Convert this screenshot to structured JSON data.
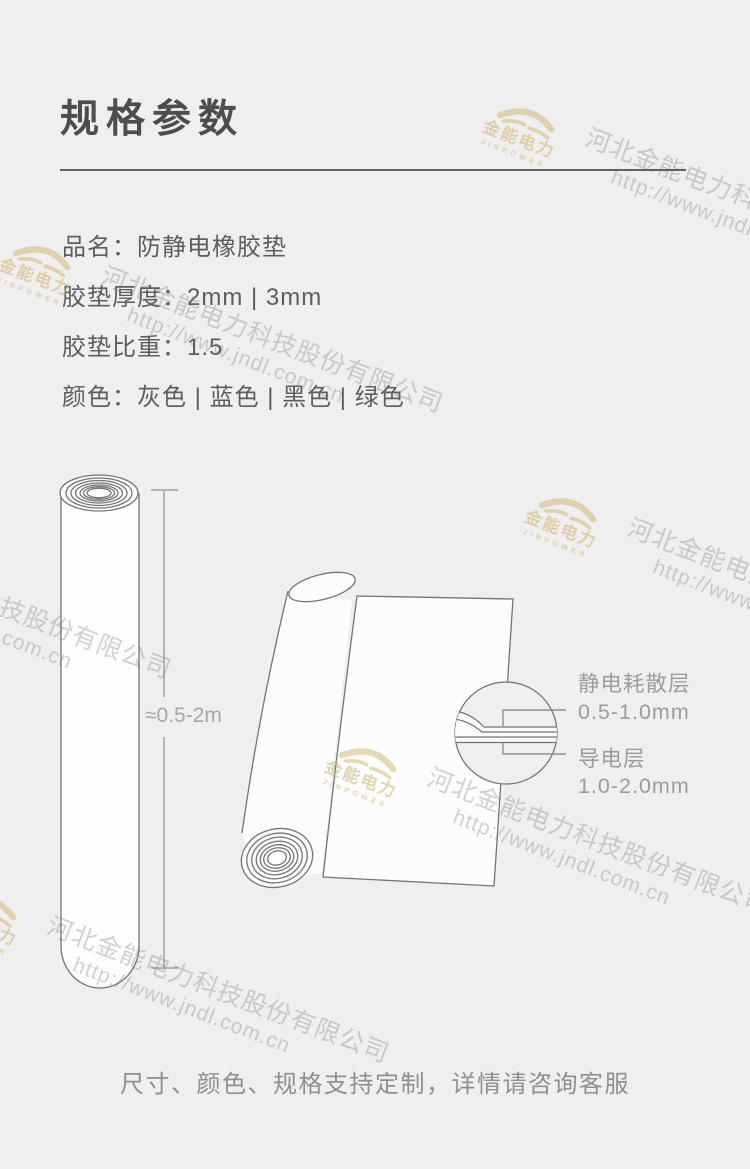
{
  "page": {
    "background": "#efefef",
    "title": "规格参数"
  },
  "specs": {
    "items": [
      {
        "text": "品名：防静电橡胶垫"
      },
      {
        "text": "胶垫厚度：2mm | 3mm"
      },
      {
        "text": "胶垫比重：1.5"
      },
      {
        "text": "颜色：灰色 | 蓝色 | 黑色 | 绿色"
      }
    ]
  },
  "diagram": {
    "roll_height_label": "≈0.5-2m",
    "layer1": {
      "name": "静电耗散层",
      "thickness": "0.5-1.0mm"
    },
    "layer2": {
      "name": "导电层",
      "thickness": "1.0-2.0mm"
    }
  },
  "footer": {
    "note": "尺寸、颜色、规格支持定制，详情请咨询客服"
  },
  "watermark": {
    "brand_cn": "金能电力",
    "brand_en": "JINPOWER",
    "company": "河北金能电力科技股份有限公司",
    "url": "http://www.jndl.com.cn",
    "gold": "#cbb46e",
    "gray": "#6e6e6e"
  },
  "colors": {
    "title_text": "#4d4d4d",
    "spec_text": "#5d5d5d",
    "note_text": "#8f8f8f",
    "line_art_stroke": "#747474",
    "dimension_stroke": "#9f9f9f",
    "label_text": "#9c9c9c"
  }
}
